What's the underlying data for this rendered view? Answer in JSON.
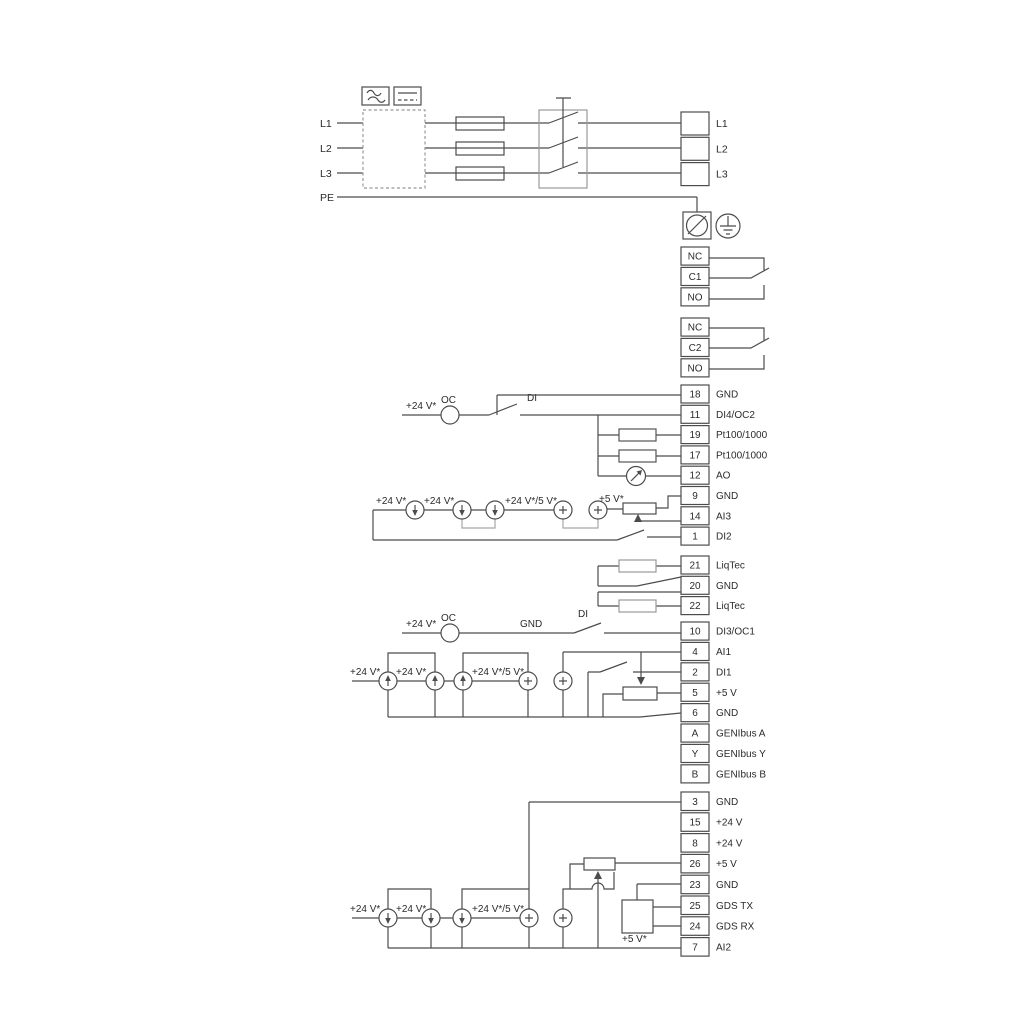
{
  "labels": {
    "plus24v": "+24 V*",
    "plus24v_5v": "+24 V*/5 V*",
    "plus5v": "+5 V*",
    "oc": "OC",
    "di": "DI",
    "gnd": "GND"
  },
  "power": {
    "inputs": [
      "L1",
      "L2",
      "L3",
      "PE"
    ],
    "outputs": [
      "L1",
      "L2",
      "L3"
    ]
  },
  "relays": [
    {
      "pins": [
        "NC",
        "C1",
        "NO"
      ]
    },
    {
      "pins": [
        "NC",
        "C2",
        "NO"
      ]
    }
  ],
  "terminal_groups": [
    {
      "id": "io-group-1",
      "terminals": [
        {
          "pin": "18",
          "label": "GND"
        },
        {
          "pin": "11",
          "label": "DI4/OC2"
        },
        {
          "pin": "19",
          "label": "Pt100/1000"
        },
        {
          "pin": "17",
          "label": "Pt100/1000"
        },
        {
          "pin": "12",
          "label": "AO"
        },
        {
          "pin": "9",
          "label": "GND"
        },
        {
          "pin": "14",
          "label": "AI3"
        },
        {
          "pin": "1",
          "label": "DI2"
        }
      ]
    },
    {
      "id": "liqtec-group",
      "terminals": [
        {
          "pin": "21",
          "label": "LiqTec"
        },
        {
          "pin": "20",
          "label": "GND"
        },
        {
          "pin": "22",
          "label": "LiqTec"
        }
      ]
    },
    {
      "id": "io-group-2",
      "terminals": [
        {
          "pin": "10",
          "label": "DI3/OC1"
        },
        {
          "pin": "4",
          "label": "AI1"
        },
        {
          "pin": "2",
          "label": "DI1"
        },
        {
          "pin": "5",
          "label": "+5 V"
        },
        {
          "pin": "6",
          "label": "GND"
        },
        {
          "pin": "A",
          "label": "GENIbus A"
        },
        {
          "pin": "Y",
          "label": "GENIbus Y"
        },
        {
          "pin": "B",
          "label": "GENIbus B"
        }
      ]
    },
    {
      "id": "io-group-3",
      "terminals": [
        {
          "pin": "3",
          "label": "GND"
        },
        {
          "pin": "15",
          "label": "+24 V"
        },
        {
          "pin": "8",
          "label": "+24 V"
        },
        {
          "pin": "26",
          "label": "+5 V"
        },
        {
          "pin": "23",
          "label": "GND"
        },
        {
          "pin": "25",
          "label": "GDS TX"
        },
        {
          "pin": "24",
          "label": "GDS RX"
        },
        {
          "pin": "7",
          "label": "AI2"
        }
      ]
    }
  ]
}
